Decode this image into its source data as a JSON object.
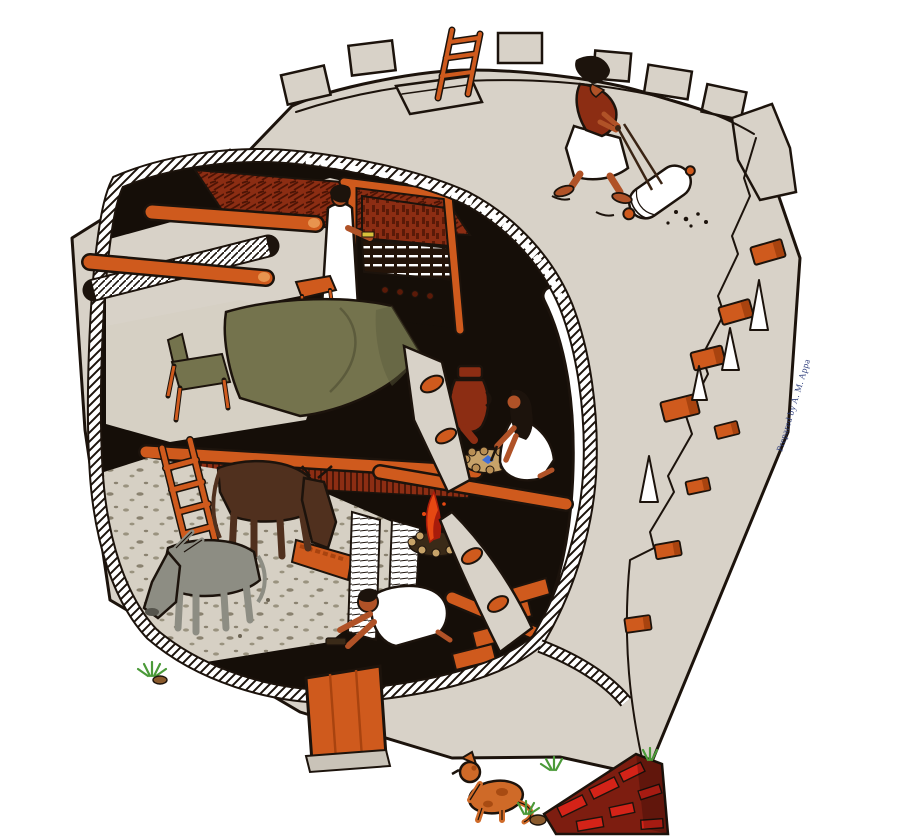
{
  "illustration": {
    "credit": "Prepared by A. M. Appa",
    "description": "Cutaway illustration of a two-storey mud-brick house with crenellated roof: a man rolls the roof with a stone roller, a woman weaves at a vertical loom beside a bed, another woman works at a hearth beside an amphora, a donkey and an ox stand in the ground-floor stable near a cooking fire and a kneeling worker; outside are a plank door, brick steps and a dog."
  },
  "scene": {
    "elements": [
      "rooftop-worker",
      "stone-roller",
      "roof-hatch-ladder",
      "crenellated-parapet",
      "weaver-woman",
      "vertical-loom",
      "bed",
      "chair",
      "stool",
      "hearth-woman",
      "amphora",
      "hearth",
      "cooking-fire",
      "stable",
      "donkey",
      "ox",
      "feeding-trough",
      "stable-ladder",
      "kneeling-worker",
      "interior-staircase",
      "plank-door",
      "beam-ends",
      "window-openings",
      "brick-steps",
      "dog",
      "grass-tufts",
      "credit-text"
    ]
  },
  "colors": {
    "background": "#ffffff",
    "wall": "#d8d2c8",
    "wall-shade": "#c9c3b8",
    "outline": "#1c130c",
    "timber": "#cf5a1d",
    "timber-light": "#e8944f",
    "timber-dark": "#a8430f",
    "maroon": "#8c2d13",
    "interior-dark": "#150e08",
    "olive": "#74734d",
    "olive-dark": "#5c5b3c",
    "donkey-gray": "#8d8d83",
    "ox-brown": "#50301e",
    "skin": "#b05227",
    "garment-white": "#ffffff",
    "brick-red": "#d42318",
    "brick-dark": "#7d1d10",
    "grass-green": "#4b9a39",
    "fire-orange": "#e64812",
    "fire-red": "#a81c0b",
    "stone-tan": "#c7a369",
    "floor-light": "#d6d0c4",
    "hearth-blue": "#3f6fd8",
    "shuttle-yellow": "#d8c23c",
    "credit-blue": "#2c3c7a"
  }
}
